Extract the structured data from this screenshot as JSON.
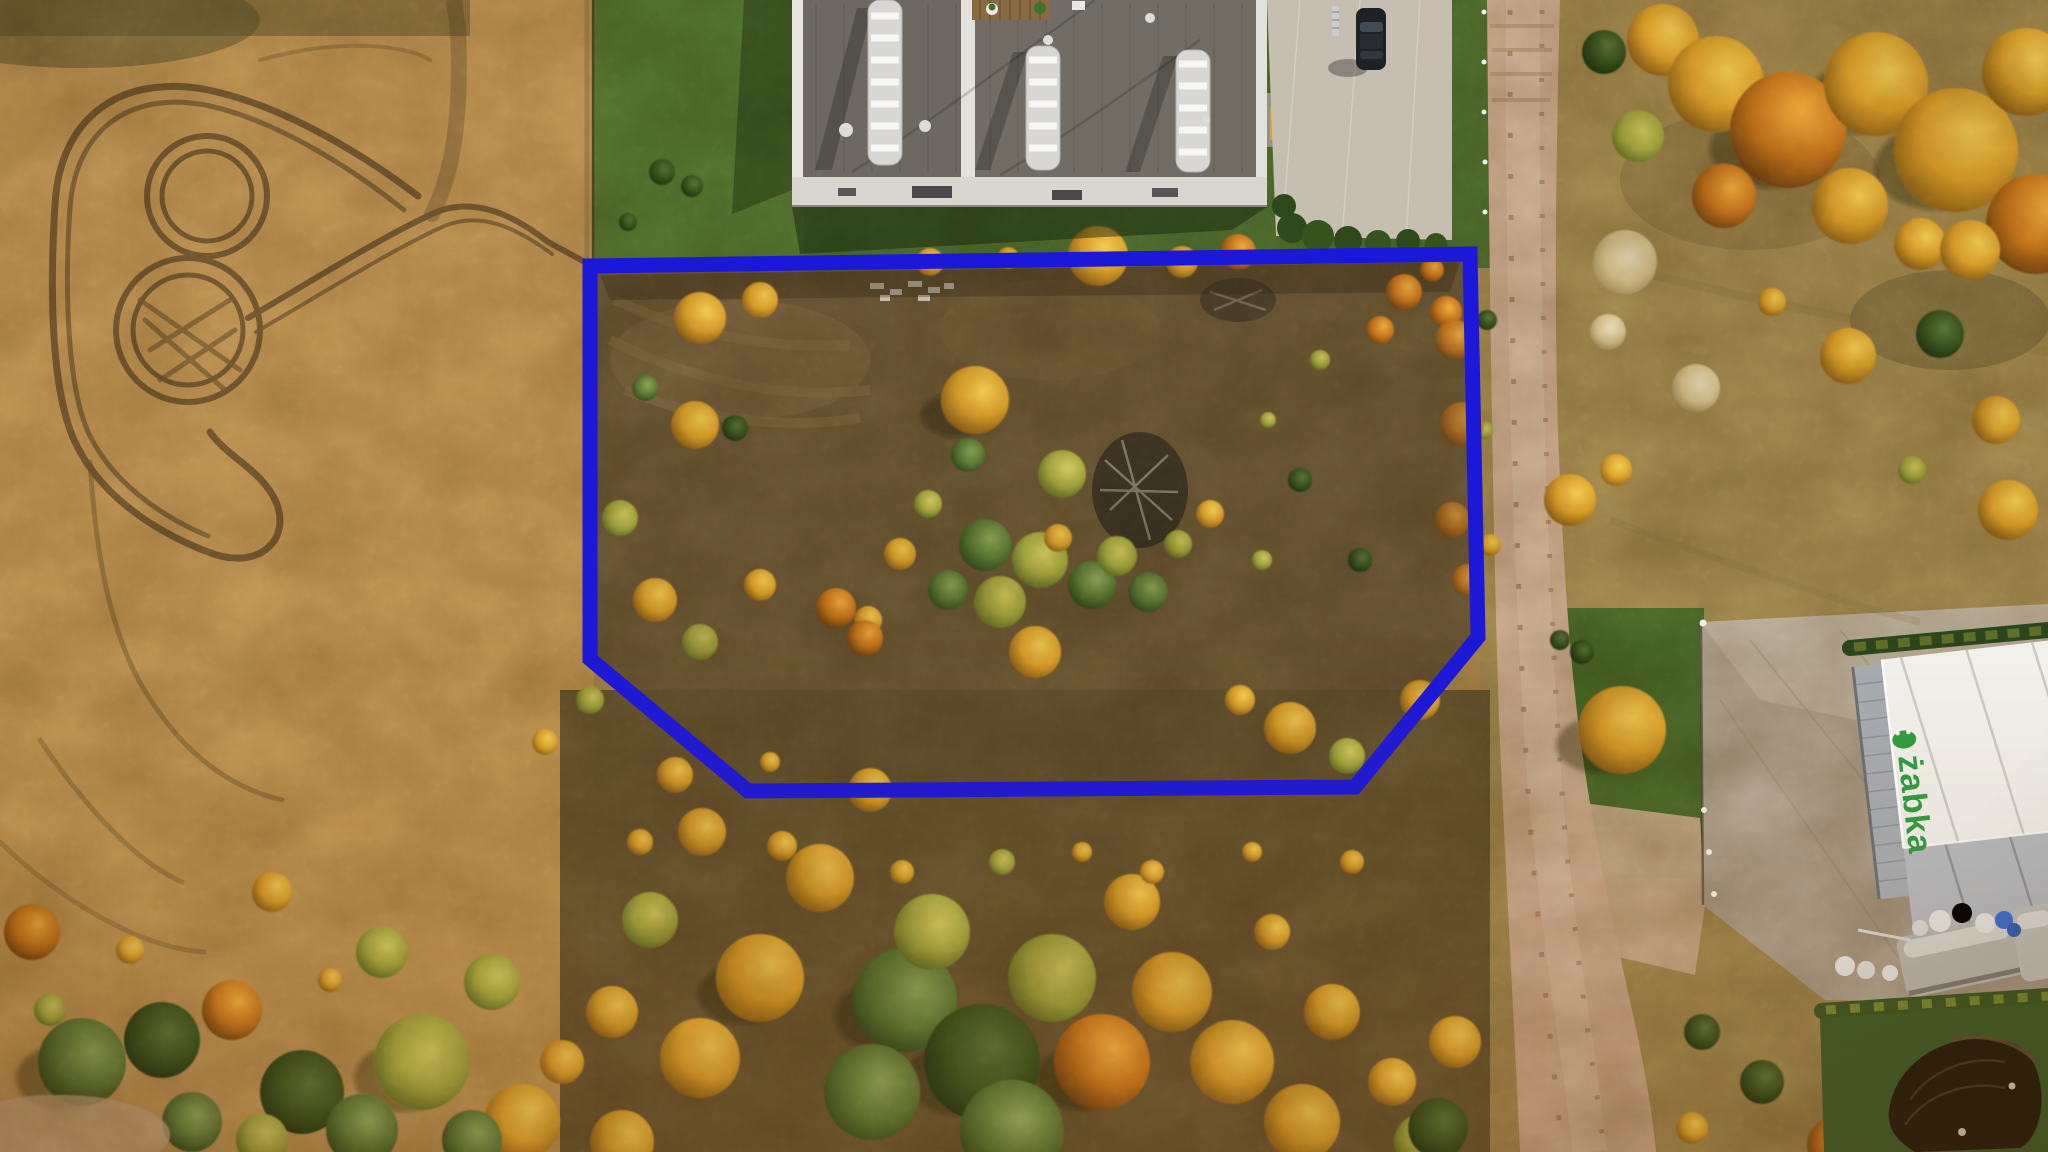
{
  "scene": {
    "description": "Aerial golden-hour drone photo of a vacant autumn plot outlined with a blue property boundary, flat-roof commercial building at top, dirt road on the right, Zabka store hall at bottom right"
  },
  "annotation": {
    "name": "plot-boundary",
    "color": "#1c18d8",
    "stroke_width": 15,
    "points": "590,266 1470,254 1478,637 1355,787 748,791 590,659"
  },
  "brand": {
    "zabka_label": "żabka",
    "zabka_color": "#2f9e41"
  },
  "palette": {
    "field_gold": "#c49a58",
    "meadow_olive": "#a68d52",
    "plot_brown": "#6e5a37",
    "lawn_green": "#527231",
    "road_tan": "#cfae94",
    "concrete": "#c6beb1",
    "roof_gray": "#716c64",
    "skylight_white": "#d8d7d3",
    "tree_gold": "#e8b83a",
    "tree_green": "#5d7d37",
    "boundary_blue": "#1c18d8"
  }
}
